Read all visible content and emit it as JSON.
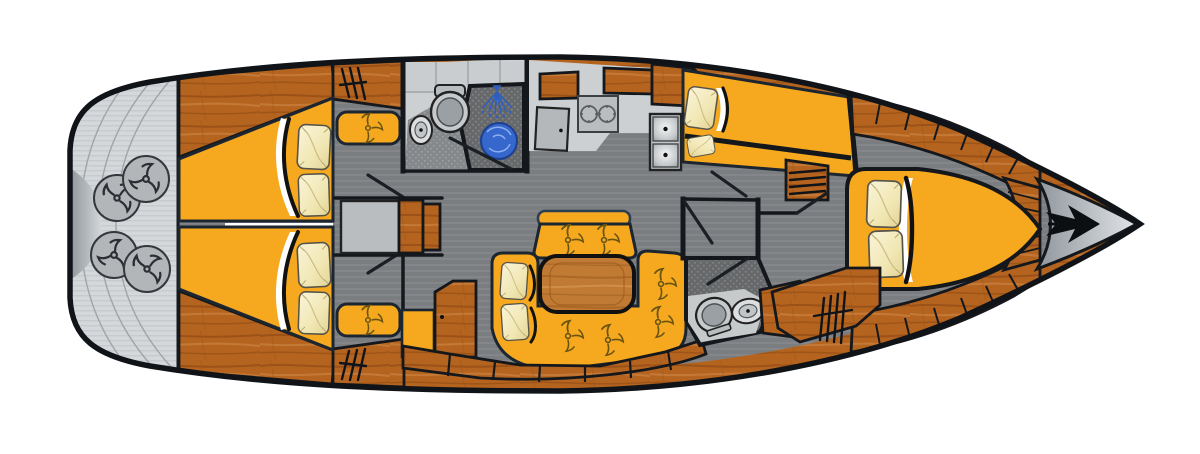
{
  "page": {
    "title": "Sailing yacht interior layout — top-down floor plan",
    "background": "#ffffff"
  },
  "orientation": {
    "bow": "right",
    "stern": "left"
  },
  "palette": {
    "hull_outline": "#14181c",
    "teak_wood": "#b4641f",
    "wood_streak_dark": "#8a4512",
    "wood_streak_light": "#d18a4a",
    "table_wood": "#c07a33",
    "upholstery_yellow": "#f6a91e",
    "cushion_cream": "#f5eec6",
    "floor_gray": "#7b7e81",
    "counter_gray": "#ccd0d2",
    "shower_floor_dark": "#66686a",
    "platform_silver": "#d5d8da",
    "water_blue": "#3567cc",
    "round_seat_gray": "#b2b6b9"
  },
  "icons": [
    "anchor-icon",
    "shower-spray-icon",
    "shower-drain-icon",
    "toilet-icon",
    "sink-icon",
    "stove-burner-icon",
    "galley-double-sink-icon",
    "button-stitch-icon",
    "propeller-seat-icon",
    "hanging-locker-icon",
    "shelf-locker-icon",
    "door-swing-icon"
  ],
  "features": {
    "cabins": 3,
    "double_berths": 4,
    "heads_compartments": 2,
    "shower_stalls": 1,
    "pillows": 10,
    "salon_table": 1,
    "u_shaped_settee": 1,
    "center_bench": 1,
    "chart_table": 1,
    "galley_burners": 2,
    "galley_sinks": 2,
    "stern_round_seats": 4,
    "anchor_locker": 1
  }
}
